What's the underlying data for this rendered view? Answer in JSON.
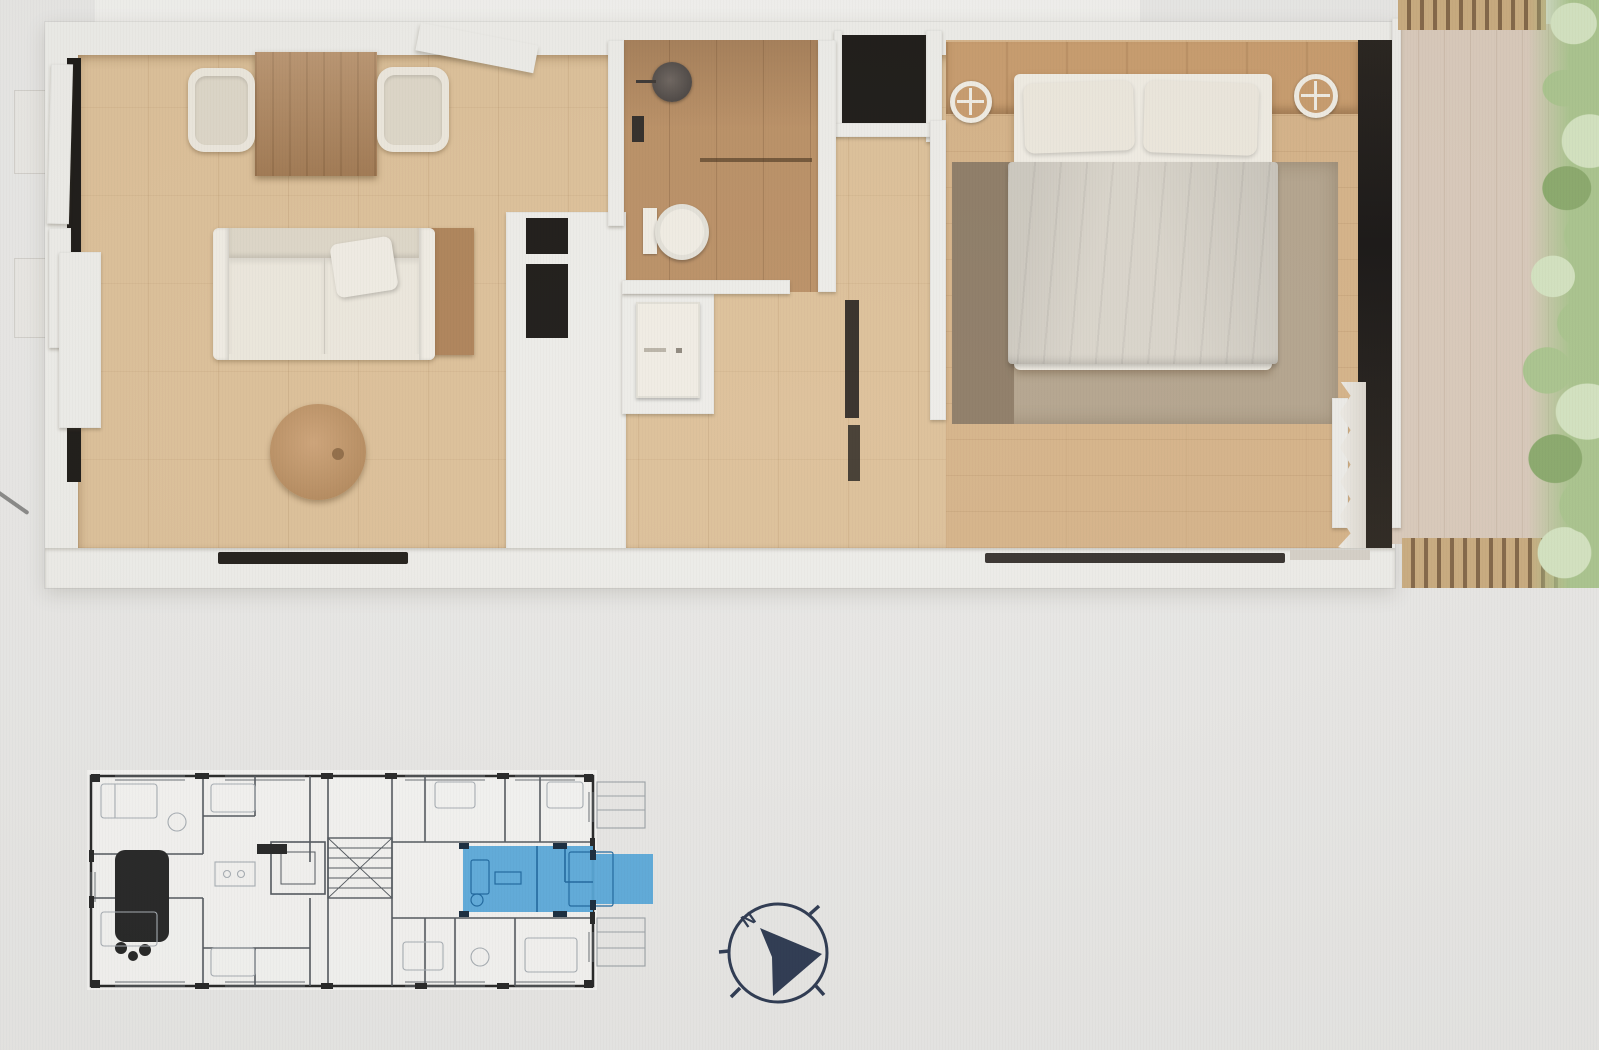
{
  "scene": {
    "type": "real-estate floor plan visualization",
    "parts": [
      "3d-apartment-render",
      "building-2d-plan-with-highlighted-unit",
      "compass-rose"
    ]
  },
  "compass": {
    "north_label": "N"
  },
  "colors": {
    "background": "#e8e7e5",
    "band_white": "#f2f1ee",
    "wall_white": "#edece8",
    "floor_oak": "#dcbf97",
    "floor_oak_deep": "#d5b287",
    "bath_floor": "#b98e63",
    "wood_table": "#ad8156",
    "headboard_wood": "#c79a6b",
    "coffee_wood": "#c59869",
    "upholstery": "#ece7dc",
    "upholstery_deep": "#ddd6c7",
    "sheet": "#f0ece3",
    "duvet": "#d9d4ca",
    "rug": "#b3a38c",
    "rug_dark": "#8c7a64",
    "black_fixture": "#191613",
    "glass_dark": "#1f1b16",
    "deck": "#d9c9ba",
    "slat_light": "#c9aa7d",
    "slat_dark": "#826545",
    "plant_light": "#d4e3c0",
    "plant_mid": "#aac48d",
    "plant_deep": "#8aa96b",
    "paper": "#f4f3f1",
    "plan_wall": "#242424",
    "plan_line": "#51565c",
    "plan_furniture": "#a7adb3",
    "unit_blue": "#55a7d9",
    "unit_blue_deep": "#1d679f",
    "unit_blue_wall": "#16293c",
    "compass_navy": "#2c3850",
    "metal_dark": "#4a4441"
  }
}
